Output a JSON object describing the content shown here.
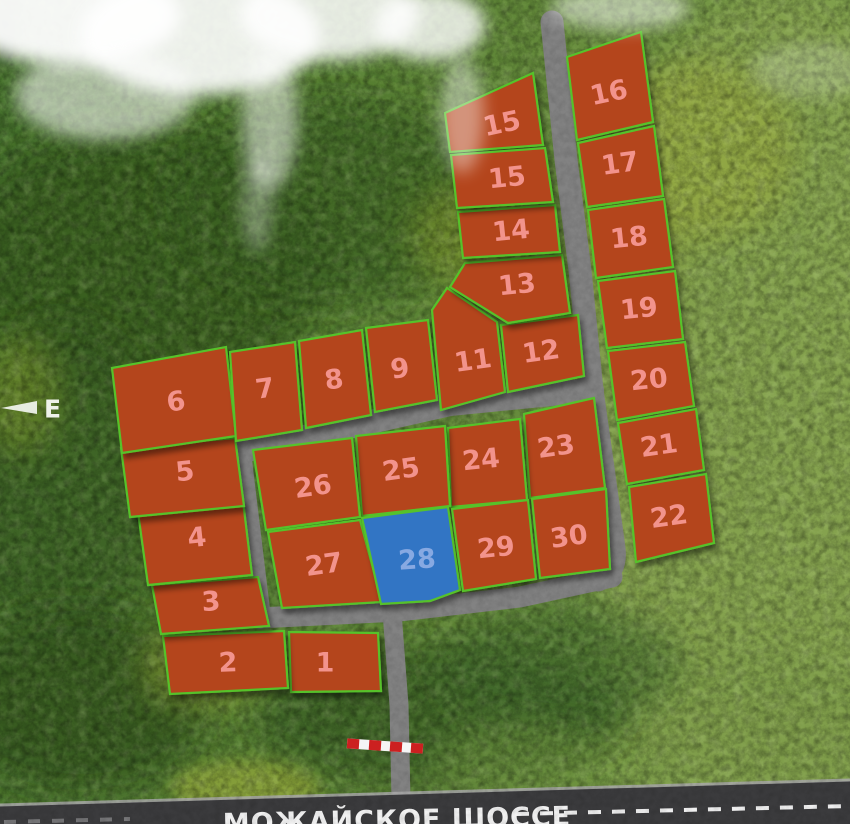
{
  "map": {
    "compass_label": "E",
    "highway": {
      "name": "МОЖАЙСКОЕ ШОССЕ"
    }
  },
  "colors": {
    "plot_available_fill": "#b4451c",
    "plot_available_number": "#f2938c",
    "plot_selected_fill": "#3274c4",
    "plot_selected_number": "#87a9e2",
    "plot_border": "#56c22c",
    "road": "#828282",
    "highway_asphalt": "#3b3b3d",
    "highway_marking": "#ffffff",
    "barrier_red": "#cc2020",
    "barrier_white": "#f5f5f5"
  },
  "plots": [
    {
      "id": "1",
      "number": "1",
      "status": "available",
      "points": "289,632 378,633 381,691 291,692",
      "label": {
        "x": 325,
        "y": 663,
        "rot": 0
      }
    },
    {
      "id": "2",
      "number": "2",
      "status": "available",
      "points": "163,636 284,631 288,688 170,694",
      "label": {
        "x": 228,
        "y": 663,
        "rot": -2
      }
    },
    {
      "id": "3",
      "number": "3",
      "status": "available",
      "points": "152,585 258,577 269,626 161,634",
      "label": {
        "x": 211,
        "y": 602,
        "rot": -4
      }
    },
    {
      "id": "4",
      "number": "4",
      "status": "available",
      "points": "138,512 243,501 252,575 148,585",
      "label": {
        "x": 197,
        "y": 538,
        "rot": -6
      }
    },
    {
      "id": "5",
      "number": "5",
      "status": "available",
      "points": "121,448 235,438 244,506 130,517",
      "label": {
        "x": 185,
        "y": 472,
        "rot": -6
      }
    },
    {
      "id": "6",
      "number": "6",
      "status": "available",
      "points": "112,368 226,347 236,436 122,453",
      "label": {
        "x": 176,
        "y": 402,
        "rot": -8
      }
    },
    {
      "id": "7",
      "number": "7",
      "status": "available",
      "points": "230,352 295,342 302,430 236,441",
      "label": {
        "x": 265,
        "y": 389,
        "rot": -8
      }
    },
    {
      "id": "8",
      "number": "8",
      "status": "available",
      "points": "299,341 362,330 371,415 306,428",
      "label": {
        "x": 334,
        "y": 380,
        "rot": -8
      }
    },
    {
      "id": "9",
      "number": "9",
      "status": "available",
      "points": "366,328 428,320 437,400 375,412",
      "label": {
        "x": 400,
        "y": 369,
        "rot": -8
      }
    },
    {
      "id": "11",
      "number": "11",
      "status": "available",
      "points": "432,310 447,288 497,322 505,392 441,410",
      "label": {
        "x": 473,
        "y": 361,
        "rot": -8
      }
    },
    {
      "id": "12",
      "number": "12",
      "status": "available",
      "points": "501,325 578,315 584,376 508,392",
      "label": {
        "x": 541,
        "y": 352,
        "rot": -8
      }
    },
    {
      "id": "13",
      "number": "13",
      "status": "available",
      "points": "465,263 562,255 570,313 508,323 450,287",
      "label": {
        "x": 517,
        "y": 285,
        "rot": -6
      }
    },
    {
      "id": "14",
      "number": "14",
      "status": "available",
      "points": "458,212 555,205 560,252 463,258",
      "label": {
        "x": 511,
        "y": 231,
        "rot": -6
      }
    },
    {
      "id": "15a",
      "number": "15",
      "status": "available",
      "points": "445,113 533,73 543,145 450,152",
      "label": {
        "x": 502,
        "y": 124,
        "rot": -12
      }
    },
    {
      "id": "15b",
      "number": "15",
      "status": "available",
      "points": "451,155 545,148 553,202 457,208",
      "label": {
        "x": 507,
        "y": 178,
        "rot": -6
      }
    },
    {
      "id": "16",
      "number": "16",
      "status": "available",
      "points": "567,57 641,32 653,122 577,140",
      "label": {
        "x": 609,
        "y": 93,
        "rot": -12
      }
    },
    {
      "id": "17",
      "number": "17",
      "status": "available",
      "points": "578,143 654,126 663,196 587,207",
      "label": {
        "x": 620,
        "y": 164,
        "rot": -8
      }
    },
    {
      "id": "18",
      "number": "18",
      "status": "available",
      "points": "588,210 664,199 673,267 596,278",
      "label": {
        "x": 629,
        "y": 238,
        "rot": -6
      }
    },
    {
      "id": "19",
      "number": "19",
      "status": "available",
      "points": "598,281 675,271 683,339 607,348",
      "label": {
        "x": 639,
        "y": 309,
        "rot": -6
      }
    },
    {
      "id": "20",
      "number": "20",
      "status": "available",
      "points": "608,351 685,342 694,406 617,420",
      "label": {
        "x": 649,
        "y": 380,
        "rot": -6
      }
    },
    {
      "id": "21",
      "number": "21",
      "status": "available",
      "points": "618,423 696,409 704,470 627,484",
      "label": {
        "x": 659,
        "y": 446,
        "rot": -8
      }
    },
    {
      "id": "22",
      "number": "22",
      "status": "available",
      "points": "629,487 706,474 714,543 636,562",
      "label": {
        "x": 669,
        "y": 517,
        "rot": -8
      }
    },
    {
      "id": "23",
      "number": "23",
      "status": "available",
      "points": "524,414 594,398 605,488 530,498",
      "label": {
        "x": 556,
        "y": 447,
        "rot": -8
      }
    },
    {
      "id": "24",
      "number": "24",
      "status": "available",
      "points": "448,428 520,419 527,500 451,507",
      "label": {
        "x": 481,
        "y": 460,
        "rot": -6
      }
    },
    {
      "id": "25",
      "number": "25",
      "status": "available",
      "points": "356,436 445,426 450,506 362,516",
      "label": {
        "x": 401,
        "y": 470,
        "rot": -8
      }
    },
    {
      "id": "26",
      "number": "26",
      "status": "available",
      "points": "253,450 352,438 360,517 266,530",
      "label": {
        "x": 313,
        "y": 487,
        "rot": -8
      }
    },
    {
      "id": "27",
      "number": "27",
      "status": "available",
      "points": "268,532 360,520 382,602 282,608",
      "label": {
        "x": 324,
        "y": 565,
        "rot": -8
      }
    },
    {
      "id": "28",
      "number": "28",
      "status": "selected",
      "points": "362,518 448,507 460,590 430,601 381,604",
      "label": {
        "x": 417,
        "y": 560,
        "rot": -4
      }
    },
    {
      "id": "29",
      "number": "29",
      "status": "available",
      "points": "452,509 528,500 536,579 463,591",
      "label": {
        "x": 496,
        "y": 548,
        "rot": -6
      }
    },
    {
      "id": "30",
      "number": "30",
      "status": "available",
      "points": "532,499 606,489 610,569 540,578",
      "label": {
        "x": 569,
        "y": 537,
        "rot": -8
      }
    }
  ]
}
